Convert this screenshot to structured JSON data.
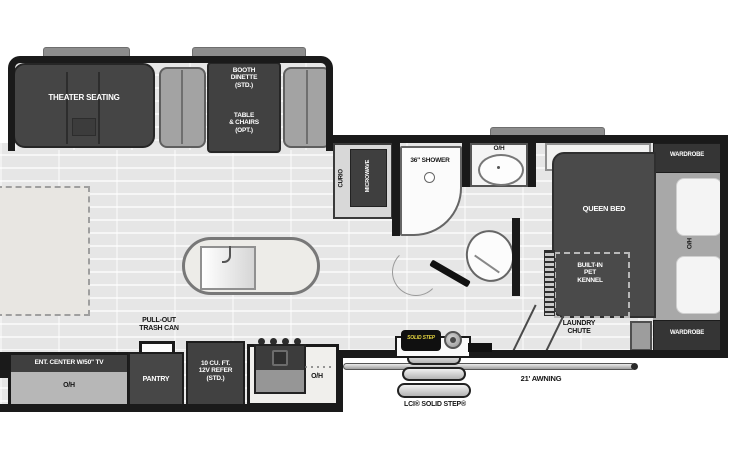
{
  "labels": {
    "theater_seating": "THEATER SEATING",
    "booth_dinette": "BOOTH\nDINETTE\n(STD.)",
    "table_chairs": "TABLE\n& CHAIRS\n(OPT.)",
    "curio": "CURIO",
    "microwave": "MICROWAVE",
    "shower": "36\" SHOWER",
    "bath_oh": "O/H",
    "wardrobe_top": "WARDROBE",
    "wardrobe_bottom": "WARDROBE",
    "queen_bed": "QUEEN BED",
    "bed_oh": "O/H",
    "pet_kennel": "BUILT-IN\nPET\nKENNEL",
    "laundry_chute": "LAUNDRY\nCHUTE",
    "pull_out_trash": "PULL-OUT\nTRASH CAN",
    "ent_center": "ENT. CENTER W/50\" TV",
    "ent_oh": "O/H",
    "pantry": "PANTRY",
    "refrigerator": "10 CU. FT.\n12V REFER\n(STD.)",
    "kitchen_oh": "O/H",
    "solid_step": "LCI® SOLID STEP®",
    "awning": "21' AWNING",
    "step_badge": "SOLID STEP"
  },
  "colors": {
    "floor": "#e6e6e6",
    "wall": "#1a1a1a",
    "dark_furniture": "#454545",
    "medium_gray": "#a3a3a3",
    "headboard_gray": "#a8a8a8",
    "fixture_white": "#fbfbfb",
    "badge_yellow": "#e3d340"
  }
}
